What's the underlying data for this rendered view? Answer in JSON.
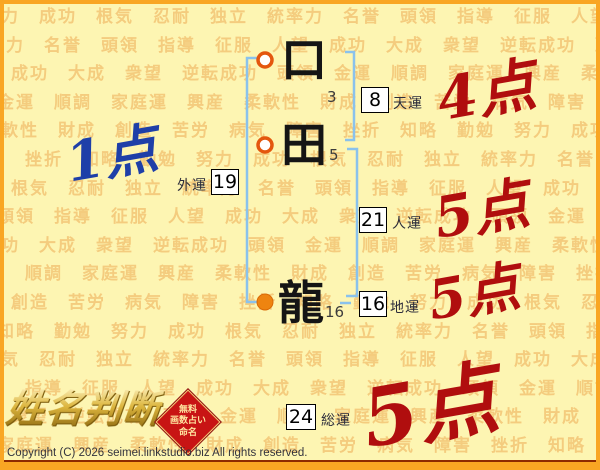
{
  "background": {
    "words": [
      "努力",
      "成功",
      "根気",
      "忍耐",
      "独立",
      "統率力",
      "名誉",
      "頭領",
      "指導",
      "征服",
      "人望",
      "成功",
      "大成",
      "衆望",
      "逆転成功",
      "頭領",
      "金運",
      "順調",
      "家庭運",
      "興産",
      "柔軟性",
      "財成",
      "創造",
      "苦労",
      "病気",
      "障害",
      "挫折",
      "知略",
      "勤勉"
    ]
  },
  "colors": {
    "page_background": "#fdf5b2",
    "frame_orange": "#f9a623",
    "watermark_orange": "#efb35f",
    "bracket_blue": "#8ac2ec",
    "marker_orange": "#ee8410",
    "score_red": "#b00e0e",
    "score_blue": "#1e3fa8",
    "seal_red": "#c81414",
    "logo_gold": "#dcb53e"
  },
  "chart": {
    "characters": [
      {
        "char": "口",
        "strokes": "3"
      },
      {
        "char": "田",
        "strokes": "5"
      },
      {
        "char": "龍",
        "strokes": "16"
      }
    ],
    "fortunes": {
      "heaven": {
        "value": "8",
        "label": "天運",
        "score": "4点"
      },
      "outer": {
        "value": "19",
        "label": "外運",
        "score": "1点"
      },
      "person": {
        "value": "21",
        "label": "人運",
        "score": "5点"
      },
      "ground": {
        "value": "16",
        "label": "地運",
        "score": "5点"
      },
      "total": {
        "value": "24",
        "label": "総運",
        "score": "5点"
      }
    }
  },
  "branding": {
    "logo": "姓名判断",
    "seal": {
      "line1": "無料",
      "line2": "画数占い",
      "line3": "命名"
    }
  },
  "footer": {
    "copyright": "Copyright (C) 2026 seimei.linkstudio.biz All rights reserved."
  }
}
